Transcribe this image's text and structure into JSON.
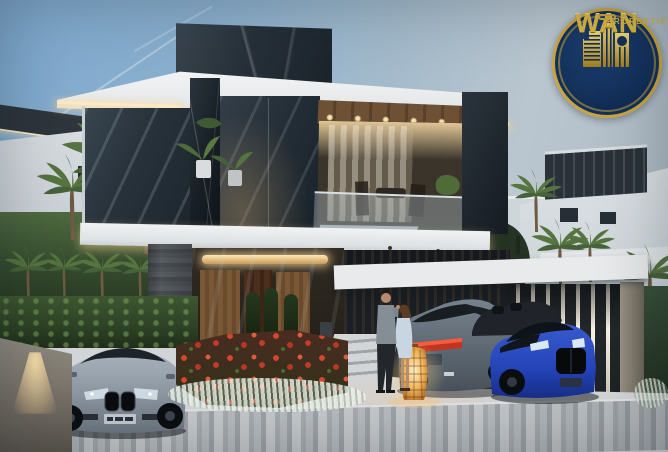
{
  "image": {
    "width": 668,
    "height": 452,
    "kind": "real-estate architectural render, dusk"
  },
  "brand_badge": {
    "name": "WAN",
    "tagline": "PROPERTIES",
    "icon": "gold-skyline-buildings-icon",
    "badge_navy": "#13305A",
    "badge_gold": "#D9B545",
    "ring_gold": "#C9A53F"
  },
  "scene": {
    "setting": "modern two-story glass villa at dusk with landscaped driveway",
    "objects": [
      "dusk-sky",
      "jet-contrails",
      "left-neighbor-villa",
      "right-neighbor-villa",
      "background-white-walls",
      "palm-trees",
      "arched-garden-hedges",
      "main-villa-dark-parapet",
      "white-roof-fascia-with-led-strip",
      "dark-marble-column",
      "glass-balcony-with-plants",
      "warm-lit-interior-with-curtains-and-dining-set",
      "wood-soffit-with-downlights",
      "ground-floor-glass-lounge-with-wood-panels",
      "slate-stone-column",
      "entry-steps",
      "carport-white-roof",
      "led-slat-wall",
      "concrete-pillar",
      "silver-bmw-coupe-front",
      "gray-blue-bmw-coupe-rear",
      "blue-bmw-coupe-front",
      "dark-convertible",
      "red-tulip-flowerbed",
      "white-ornamental-grasses",
      "hedge-wall",
      "concrete-planter-with-uplight",
      "standing-couple",
      "glowing-wicker-floor-lantern",
      "paved-driveway",
      "striped-paver-road"
    ],
    "people_count": 2,
    "vehicle_count": 4,
    "legible_text": "none besides brand badge"
  },
  "palette": {
    "sky_top": "#7FA9CE",
    "sky_horizon": "#BAC6CF",
    "villa_white": "#EDEFF1",
    "villa_glass": "#27323B",
    "marble_dark": "#161D23",
    "wood_warm": "#6B4E31",
    "led_warm": "#FFE9C0",
    "interior_glow": "#F4D9A0",
    "hedge_green": "#2C4024",
    "flower_red": "#C83A28",
    "grass_white": "#E6EEE1",
    "pavement": "#CDD0D2",
    "road_paver": "#A8ADB1",
    "car_silver": "#97A1AC",
    "car_blue": "#2444B8",
    "car_gray": "#76828E",
    "taillight_red": "#C23422",
    "lantern_glow": "#F5C069",
    "concrete": "#8D887E",
    "slat_dark": "#23272B",
    "led_strip": "#F6F1DF"
  }
}
